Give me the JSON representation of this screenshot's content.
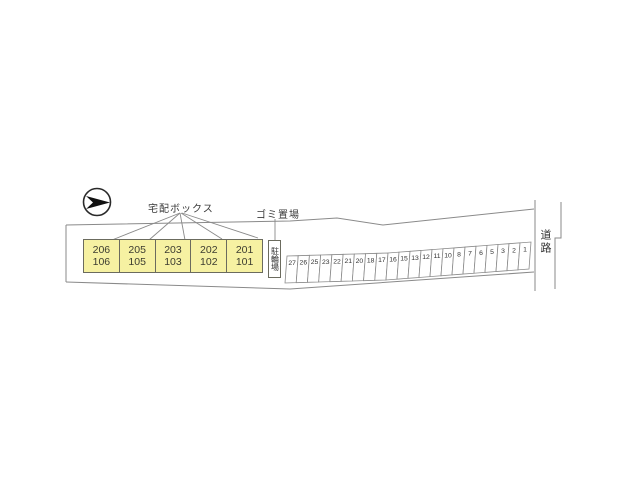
{
  "labels": {
    "delivery_box": "宅配ボックス",
    "garbage_area": "ゴミ置場",
    "bicycle_parking": "駐輪場",
    "road": "道路"
  },
  "building": {
    "rooms": [
      {
        "upper": "206",
        "lower": "106"
      },
      {
        "upper": "205",
        "lower": "105"
      },
      {
        "upper": "203",
        "lower": "103"
      },
      {
        "upper": "202",
        "lower": "102"
      },
      {
        "upper": "201",
        "lower": "101"
      }
    ]
  },
  "parking": {
    "spaces": [
      "27",
      "26",
      "25",
      "23",
      "22",
      "21",
      "20",
      "18",
      "17",
      "16",
      "15",
      "13",
      "12",
      "11",
      "10",
      "8",
      "7",
      "6",
      "5",
      "3",
      "2",
      "1"
    ]
  },
  "icons": {
    "compass": "north-arrow-icon"
  },
  "colors": {
    "room_fill": "#f6f1a2",
    "line": "#888888",
    "text": "#333333"
  }
}
